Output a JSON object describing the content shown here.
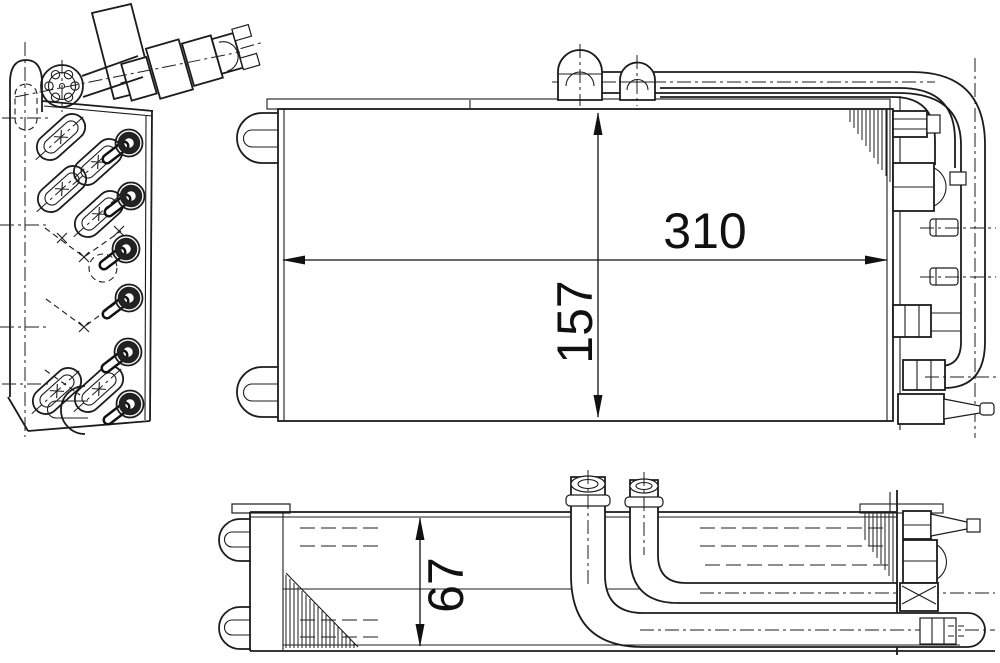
{
  "page": {
    "background": "#ffffff",
    "ink": "#1c1c1c"
  },
  "drawing": {
    "dimensions": {
      "width_label": "310",
      "height_label": "157",
      "depth_label": "67"
    }
  }
}
